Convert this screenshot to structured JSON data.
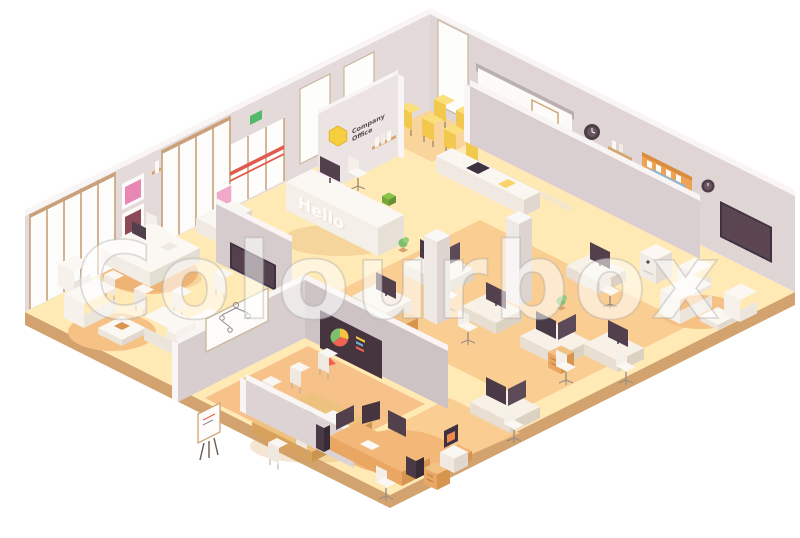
{
  "artwork": {
    "title": "Isometric company office interior",
    "style": "low-poly isometric vector illustration",
    "background_color": "#ffffff"
  },
  "watermark": {
    "text": "Colourbox"
  },
  "signs": {
    "company_sign": {
      "line1": "Company",
      "line2": "Office",
      "logo": "hexagon-icon",
      "logo_color": "#f6cf3f",
      "text_color": "#594a52"
    },
    "reception_desk": {
      "text": "Hello"
    },
    "exit_sign": {
      "color": "#53b96a"
    }
  },
  "palette": {
    "floor_pale": "#ffe9b4",
    "floor_peach": "#f9cb8f",
    "slab_edge": "#d2a36f",
    "wall_light": "#e3dad9",
    "wall_mid": "#d8cecf",
    "wall_dark": "#cdc3c5",
    "wall_top": "#f8f5f4",
    "furniture_white": "#f6f2ec",
    "wood_tan": "#e9a763",
    "screen_dark": "#46353f",
    "monitor_purple": "#53404d",
    "accent_yellow": "#f9d468",
    "accent_red": "#e05a4e",
    "accent_green": "#7fbf6e",
    "map_blue": "#85b6db",
    "cork_orange": "#efa251",
    "art_pink": "#e886b4"
  },
  "rooms": [
    {
      "name": "Reception",
      "items": [
        "reception desk with Hello sign",
        "computer monitor",
        "receptionist chair",
        "wall shelf with books",
        "company logo wall",
        "green plant"
      ]
    },
    {
      "name": "Training room",
      "items": [
        "projection screen",
        "wall clock",
        "two rows of yellow chairs",
        "lectern with laptop",
        "mobile whiteboard",
        "low storage cabinet with laptop"
      ]
    },
    {
      "name": "Executive office",
      "items": [
        "executive desk",
        "office chair",
        "monitor",
        "two pink wall pictures",
        "wall shelves",
        "sideboard with mirror",
        "wall TV",
        "meeting table with chairs"
      ]
    },
    {
      "name": "Lounge left",
      "items": [
        "white sofas",
        "armchairs",
        "coffee table",
        "round rug"
      ]
    },
    {
      "name": "Conference room",
      "items": [
        "conference table",
        "white chairs",
        "laptop",
        "presentation screen with pie chart",
        "whiteboard with tree diagram",
        "flip chart"
      ]
    },
    {
      "name": "Open-plan office",
      "items": [
        "workstation desks with dark monitors",
        "task chairs",
        "white columns",
        "drawer units",
        "plants"
      ]
    },
    {
      "name": "Lounge right",
      "items": [
        "armchairs",
        "sofa",
        "coffee table",
        "wall TV",
        "cork board with world map",
        "wall clocks",
        "office copier"
      ]
    },
    {
      "name": "Corner workstation",
      "items": [
        "L-shaped desk",
        "three monitors",
        "office chair",
        "3D printer",
        "PC tower",
        "speaker",
        "drawer unit"
      ]
    }
  ]
}
